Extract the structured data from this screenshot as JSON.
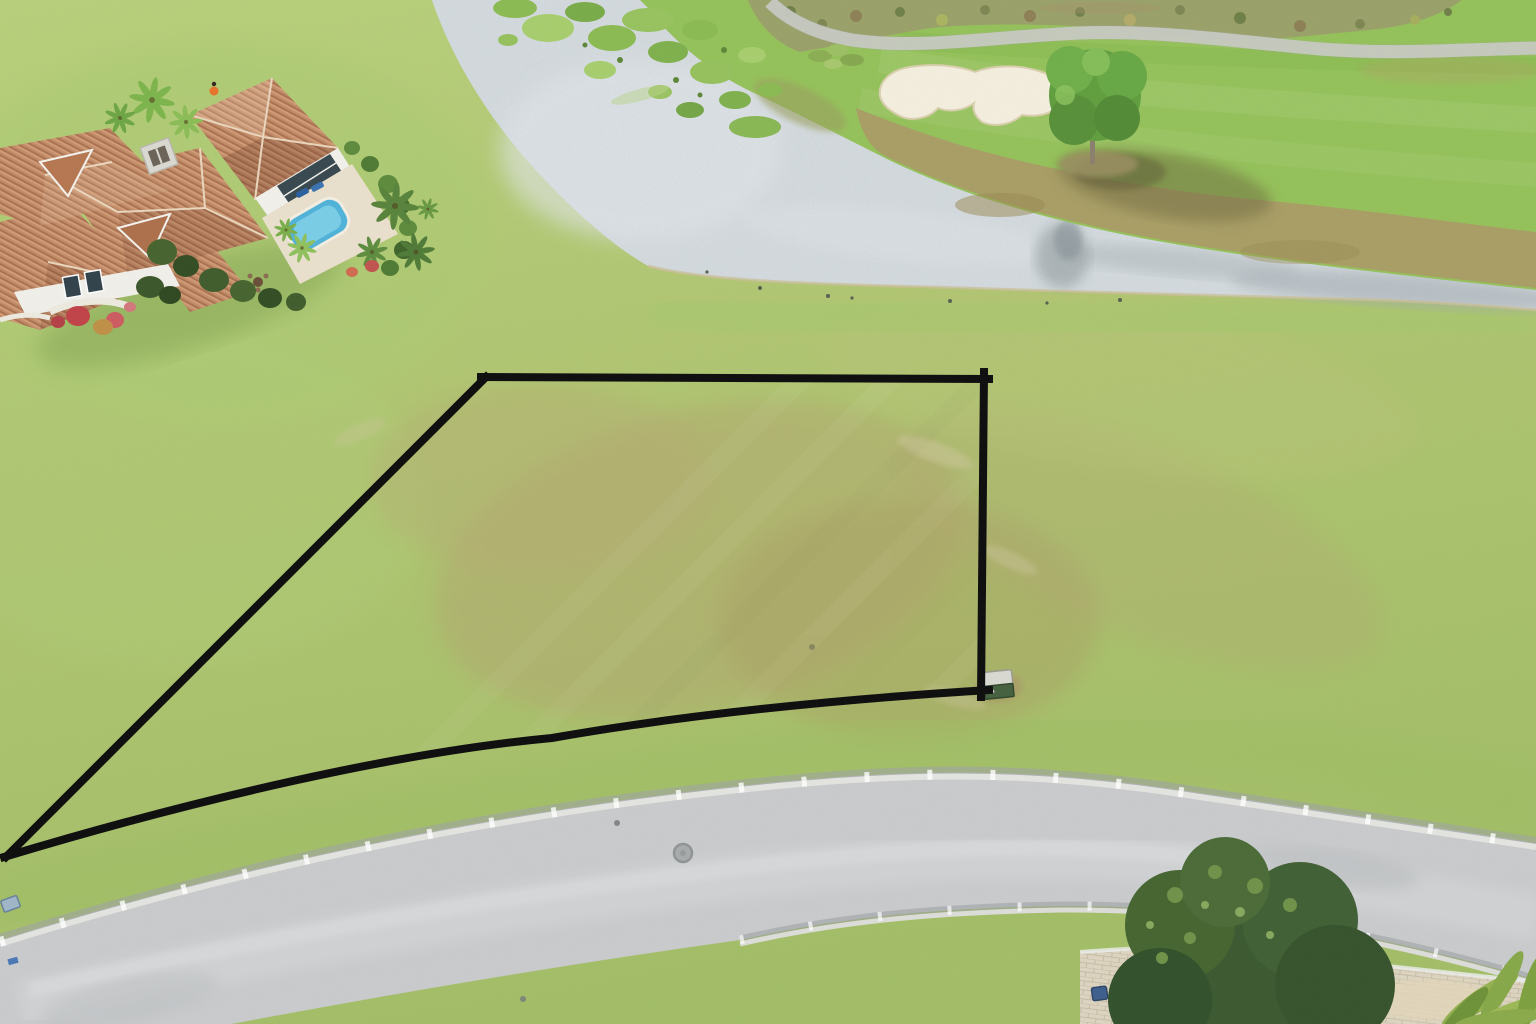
{
  "meta": {
    "type": "aerial-drone-photograph",
    "subject": "Vacant residential home-site outlined in black, bordered by a road, a lake and a golf course fairway with sand bunker",
    "width": 1536,
    "height": 1024
  },
  "colors": {
    "grass_top": "#b7cf7a",
    "grass_mid": "#afc470",
    "grass_bottom": "#a2bd66",
    "lot_tan": "#b1a76e",
    "water": "#d3dade",
    "water_dark_edge": "#9aa5ac",
    "fairway": "#94c159",
    "rough": "#a89d64",
    "scrub": "#99a068",
    "cart_path": "#d3d5cf",
    "sand_bunker": "#f3eedd",
    "road_asphalt": "#c8cacc",
    "curb_concrete": "#e3e4e0",
    "roof_tile": "#c08a66",
    "house_wall": "#f1f0ea",
    "pool_blue": "#4fb2d8",
    "oak_tree": "#3a5830",
    "pine_tree": "#649f41",
    "driveway_paver": "#dcd4c0",
    "outline_black": "#0c0c0c"
  },
  "water": {
    "fill": "#d3dade",
    "region_d": "M432,0 C452,60 492,125 545,180 C585,222 620,250 648,266 C700,280 800,284 930,287 C1080,292 1250,297 1380,300 C1432,302 1490,306 1536,310 L1536,288 C1430,276 1300,263 1180,243 C1060,223 960,193 885,156 C845,136 795,110 752,90 C710,70 672,38 648,6 L640,0 Z",
    "shore_line_d": "M648,266 C700,280 800,284 930,287 C1080,292 1250,297 1380,300 C1432,302 1490,306 1536,310"
  },
  "land": {
    "fill": "#94c159",
    "region_d": "M640,0 L1536,0 L1536,290 C1430,278 1300,265 1180,245 C1060,225 960,195 885,158 C845,138 795,112 752,92 C710,72 672,40 648,8 Z"
  },
  "golf": {
    "rough_fill": "#a89d64",
    "rough_d": "M856,108 C890,122 925,134 960,145 C1040,168 1150,190 1260,200 C1360,209 1450,222 1536,232 L1536,288 C1430,276 1300,263 1180,243 C1060,223 960,193 885,156 C870,148 860,130 856,108 Z",
    "scrub_fill": "#99a068",
    "scrub_d": "M748,0 L1462,0 C1440,16 1410,26 1370,30 C1300,36 1230,48 1150,32 C1080,24 990,22 930,28 C884,36 836,46 800,52 C776,44 756,22 748,0 Z",
    "cart_path_color": "#d3d5cf",
    "cart_path_d": "M770,2 C790,22 818,34 852,40 C920,50 1000,36 1080,33 C1160,30 1240,42 1320,49 C1400,55 1470,49 1536,48",
    "bunker_fill": "#f3eedd",
    "bunker_d": "M880,96 C878,82 890,70 910,67 C935,63 960,66 975,72 C990,66 1015,64 1035,70 C1058,76 1070,88 1064,100 C1058,112 1040,118 1022,115 C1012,124 996,128 982,122 C975,116 972,110 974,103 C965,110 950,113 938,108 C930,118 912,122 900,116 C888,110 882,104 880,96 Z"
  },
  "road": {
    "fill": "#c8cacc",
    "band_d": "M0,940 C230,868 470,816 720,788 C900,768 1020,766 1180,790 C1320,810 1440,828 1536,843 L1536,980 C1490,966 1440,953 1380,940 C1300,922 1180,905 1060,906 C940,908 840,917 740,940 C490,975 240,1020 0,1070 Z",
    "top_curb_d": "M0,940 C230,868 470,816 720,788 C900,768 1020,766 1180,790 C1320,810 1440,828 1536,843",
    "bottom_curb_d": "M740,940 C840,917 940,908 1060,906 C1180,905 1300,922 1380,940 C1440,953 1490,966 1536,980"
  },
  "driveway": {
    "fill": "#dcd4c0",
    "region_d": "M1080,952 C1140,947 1200,946 1240,950 L1536,982 L1536,1024 L1080,1024 Z",
    "grass_wedge_fill": "#85b252",
    "grass_wedge_d": "M1232,950 L1362,988 L1232,1024 L1206,1024 Z"
  },
  "lot_boundary": {
    "stroke_color": "#0c0c0c",
    "stroke_width": 8,
    "region_d": "M486,377 L984,379 L981,694 C860,702 700,716 552,738 C400,752 200,798 6,856 Z",
    "top_edge_d": "M481,377 L989,379",
    "right_edge_d": "M984,372 L981,697",
    "bottom_edge_d": "M989,690 C860,698 700,712 552,738 C400,752 200,798 4,857",
    "left_edge_d": "M6,857 L486,377"
  }
}
